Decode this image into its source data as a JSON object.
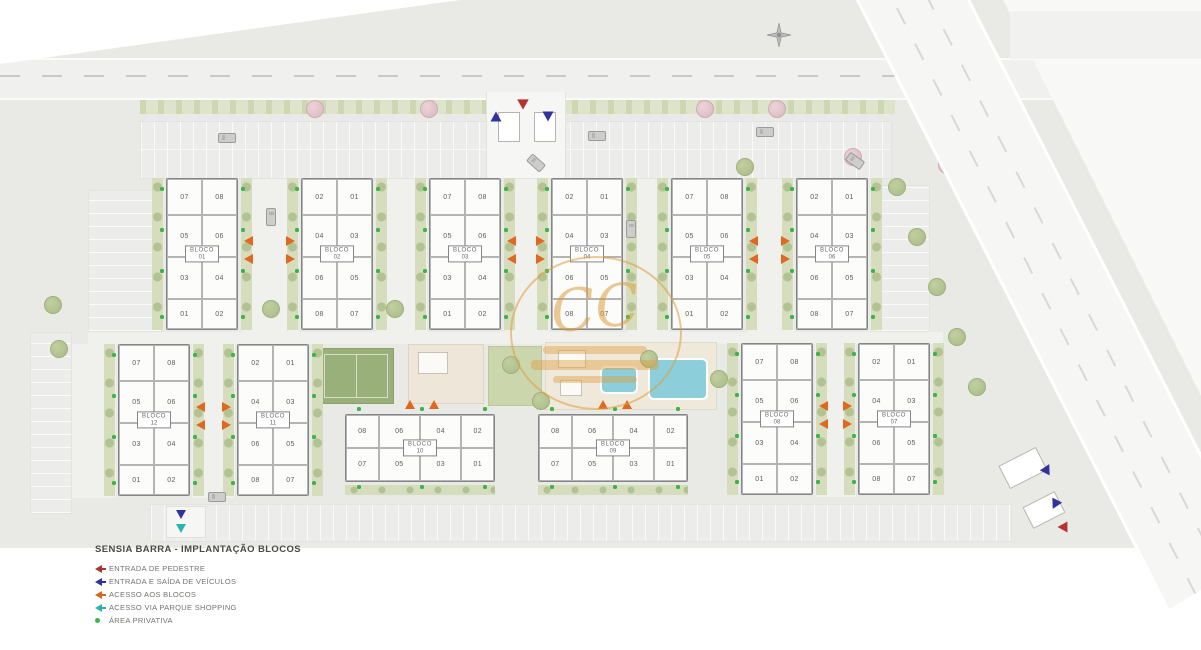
{
  "legend": {
    "title": "SENSIA BARRA - IMPLANTAÇÃO BLOCOS",
    "items": [
      {
        "label": "ENTRADA DE PEDESTRE",
        "color": "#a8352e",
        "icon": "arrow"
      },
      {
        "label": "ENTRADA E SAÍDA DE VEÍCULOS",
        "color": "#32329e",
        "icon": "arrow"
      },
      {
        "label": "ACESSO AOS BLOCOS",
        "color": "#d2691e",
        "icon": "arrow"
      },
      {
        "label": "ACESSO VIA PARQUE SHOPPING",
        "color": "#2ab5ac",
        "icon": "arrow"
      },
      {
        "label": "ÁREA PRIVATIVA",
        "color": "#3bb54a",
        "icon": "dot"
      }
    ]
  },
  "watermark": {
    "monogram": "CC"
  },
  "marker_colors": {
    "pedestrian": "#b5342f",
    "vehicle": "#32329e",
    "block_access": "#e0681f",
    "shopping_access": "#2ab5ac",
    "private_area": "#3bb54a"
  },
  "blocks": {
    "label_prefix": "BLOCO",
    "unit_patterns": {
      "A": [
        [
          "07",
          "08"
        ],
        [
          "05",
          "06"
        ],
        [
          "03",
          "04"
        ],
        [
          "01",
          "02"
        ]
      ],
      "B": [
        [
          "02",
          "01"
        ],
        [
          "04",
          "03"
        ],
        [
          "06",
          "05"
        ],
        [
          "08",
          "07"
        ]
      ],
      "H": [
        [
          "08",
          "06",
          "04",
          "02"
        ],
        [
          "07",
          "05",
          "03",
          "01"
        ]
      ]
    },
    "list": [
      {
        "num": "01",
        "type": "A"
      },
      {
        "num": "02",
        "type": "B"
      },
      {
        "num": "03",
        "type": "A"
      },
      {
        "num": "04",
        "type": "B"
      },
      {
        "num": "05",
        "type": "A"
      },
      {
        "num": "06",
        "type": "B"
      },
      {
        "num": "07",
        "type": "B"
      },
      {
        "num": "08",
        "type": "A"
      },
      {
        "num": "09",
        "type": "H"
      },
      {
        "num": "10",
        "type": "H"
      },
      {
        "num": "11",
        "type": "B"
      },
      {
        "num": "12",
        "type": "A"
      }
    ]
  }
}
